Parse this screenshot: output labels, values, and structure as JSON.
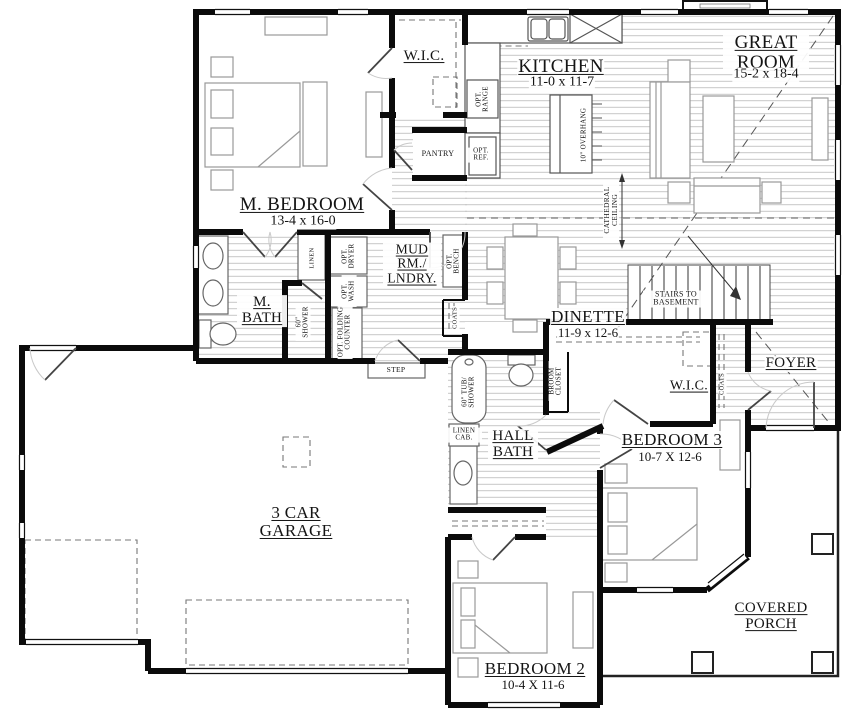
{
  "rooms": {
    "master_wic": {
      "name": "W.I.C."
    },
    "kitchen": {
      "name": "KITCHEN",
      "dims": "11-0 x 11-7"
    },
    "great_room": {
      "name": "GREAT ROOM",
      "dims": "15-2 x 18-4"
    },
    "master_bedroom": {
      "name": "M. BEDROOM",
      "dims": "13-4 x 16-0"
    },
    "master_bath": {
      "name": "M. BATH"
    },
    "mud_room": {
      "name": "MUD RM./ LNDRY."
    },
    "dinette": {
      "name": "DINETTE",
      "dims": "11-9 x 12-6"
    },
    "foyer": {
      "name": "FOYER"
    },
    "bedroom3_wic": {
      "name": "W.I.C."
    },
    "bedroom3": {
      "name": "BEDROOM 3",
      "dims": "10-7 X 12-6"
    },
    "hall_bath": {
      "name": "HALL BATH"
    },
    "garage": {
      "name": "3 CAR GARAGE"
    },
    "bedroom2": {
      "name": "BEDROOM 2",
      "dims": "10-4 X 11-6"
    },
    "covered_porch": {
      "name": "COVERED PORCH"
    }
  },
  "annotations": {
    "stairs": "STAIRS TO BASEMENT",
    "pantry": "PANTRY",
    "opt_range": "OPT. RANGE",
    "opt_ref": "OPT. REF.",
    "overhang": "10\" OVERHANG",
    "cathedral_ceiling": "CATHEDRAL CEILING",
    "linen": "LINEN",
    "opt_dryer": "OPT. DRYER",
    "opt_wash": "OPT. WASH",
    "opt_folding_counter": "OPT. FOLDING COUNTER",
    "opt_bench": "OPT. BENCH",
    "coats_mud": "COATS",
    "coats_foyer": "COATS",
    "shower": "60\" SHOWER",
    "tub_shower": "60\" TUB/ SHOWER",
    "broom_closet": "BROOM CLOSET",
    "linen_cab": "LINEN CAB.",
    "step": "STEP"
  },
  "colors": {
    "wall": "#0b0b0b",
    "hatch": "#b9b9b9",
    "furniture": "#999999"
  }
}
